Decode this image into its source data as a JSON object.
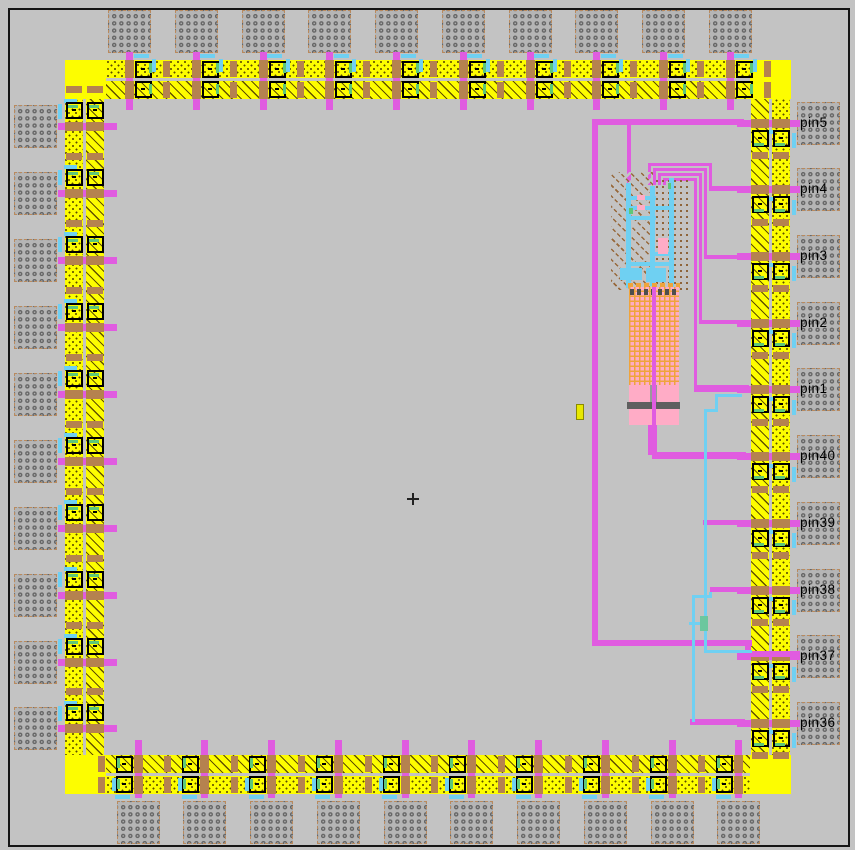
{
  "app": {
    "type": "ic-layout-viewer",
    "background": "#c3c3c3",
    "frame_color": "#161616"
  },
  "colors": {
    "yellow": "#fdfd00",
    "magenta": "#e05ce0",
    "cyan": "#6fd0f2",
    "tan_via": "#b5824f",
    "green_contact": "#5ec878",
    "green_via": "#6cc79e",
    "pink": "#ffacc6",
    "orange": "#efa43c",
    "dark_gray": "#5f5f5f",
    "bond_gray": "#b5b5b5",
    "label_color": "#000000"
  },
  "pad_ring": {
    "pads_per_edge": 10,
    "total_pads": 40,
    "right_pin_labels": [
      "pin5",
      "pin4",
      "pin3",
      "pin2",
      "pin1",
      "pin40",
      "pin39",
      "pin38",
      "pin37",
      "pin36"
    ]
  },
  "crosshair": {
    "x": 413,
    "y": 499
  },
  "loose_rect_marker": {
    "x": 576,
    "y": 404,
    "w": 6,
    "h": 14
  },
  "wires": {
    "magenta": [
      [
        592,
        119,
        6,
        527
      ],
      [
        592,
        119,
        152,
        6
      ],
      [
        627,
        122,
        4,
        62
      ],
      [
        648,
        163,
        64,
        3
      ],
      [
        653,
        168,
        54,
        3
      ],
      [
        658,
        173,
        44,
        3
      ],
      [
        663,
        178,
        34,
        3
      ],
      [
        648,
        163,
        3,
        22
      ],
      [
        653,
        168,
        3,
        17
      ],
      [
        658,
        173,
        3,
        12
      ],
      [
        663,
        178,
        3,
        7
      ],
      [
        709,
        163,
        3,
        27
      ],
      [
        704,
        168,
        3,
        91
      ],
      [
        699,
        173,
        3,
        151
      ],
      [
        694,
        178,
        3,
        212
      ],
      [
        709,
        186,
        36,
        5
      ],
      [
        704,
        255,
        41,
        4
      ],
      [
        699,
        320,
        46,
        4
      ],
      [
        694,
        385,
        55,
        7
      ],
      [
        648,
        425,
        9,
        30
      ],
      [
        652,
        452,
        94,
        7
      ],
      [
        703,
        520,
        42,
        5
      ],
      [
        710,
        587,
        35,
        5
      ],
      [
        592,
        640,
        160,
        6
      ],
      [
        745,
        640,
        6,
        17
      ],
      [
        745,
        651,
        55,
        6
      ],
      [
        690,
        719,
        55,
        6
      ]
    ],
    "cyan": [
      [
        715,
        394,
        27,
        3
      ],
      [
        715,
        394,
        3,
        18
      ],
      [
        704,
        409,
        14,
        3
      ],
      [
        704,
        409,
        3,
        209
      ],
      [
        704,
        630,
        3,
        23
      ],
      [
        704,
        650,
        48,
        3
      ],
      [
        709,
        592,
        3,
        6
      ],
      [
        692,
        595,
        20,
        3
      ],
      [
        692,
        595,
        3,
        127
      ],
      [
        689,
        622,
        13,
        3
      ]
    ],
    "green_vias": [
      [
        700,
        616,
        8,
        15
      ]
    ]
  },
  "circuit_block": {
    "hatch_region": [
      611,
      172,
      42,
      118
    ],
    "dot_region": [
      654,
      178,
      38,
      114
    ],
    "cyan_rails": [
      [
        626,
        183,
        5,
        105
      ],
      [
        650,
        186,
        5,
        100
      ],
      [
        669,
        178,
        5,
        110
      ]
    ],
    "cyan_rungs": [
      [
        626,
        196,
        30,
        4
      ],
      [
        626,
        206,
        48,
        4
      ],
      [
        626,
        216,
        30,
        4
      ],
      [
        650,
        252,
        24,
        4
      ],
      [
        626,
        262,
        48,
        4
      ]
    ],
    "cyan_combs": [
      [
        620,
        268,
        22,
        12
      ],
      [
        646,
        268,
        20,
        14
      ]
    ],
    "pink_bits": [
      [
        637,
        195,
        8,
        5
      ],
      [
        637,
        205,
        8,
        5
      ],
      [
        658,
        238,
        10,
        16
      ]
    ],
    "green_bits": [
      [
        629,
        208,
        4,
        6
      ],
      [
        668,
        183,
        3,
        6
      ]
    ],
    "orange_dash_row": [
      628,
      283,
      52,
      5
    ],
    "cap_block": [
      629,
      287,
      50,
      100
    ],
    "cap_dark_row": [
      630,
      289,
      48,
      6
    ],
    "cap_center_line": [
      652,
      287,
      4,
      140
    ],
    "pink_foot": [
      629,
      385,
      50,
      40
    ],
    "gray_stub": [
      650,
      385,
      7,
      17
    ],
    "dark_bar": [
      627,
      402,
      53,
      7
    ],
    "white_dot": [
      652,
      404,
      2,
      2
    ]
  }
}
